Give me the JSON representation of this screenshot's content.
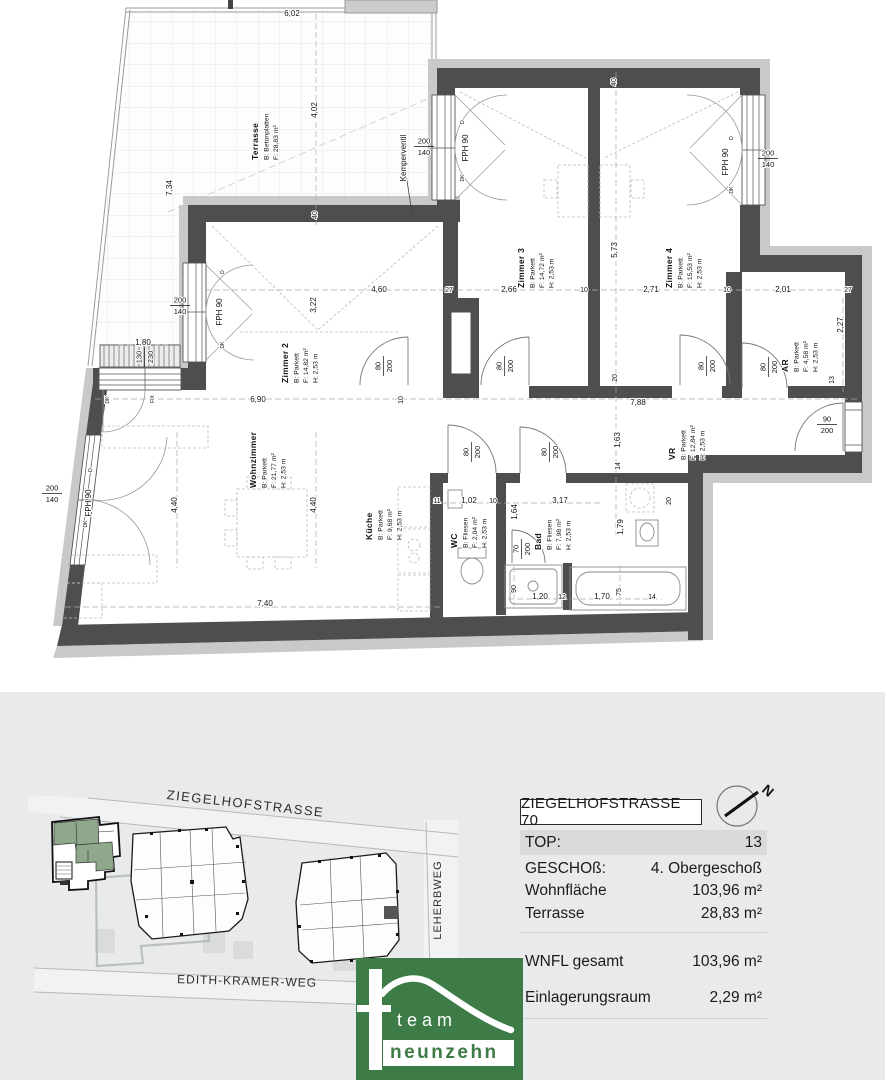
{
  "panel": {
    "address": "ZIEGELHOFSTRASSE 70",
    "compass_n": "N",
    "rows": [
      {
        "label": "TOP:",
        "value": "13"
      },
      {
        "label": "GESCHOß:",
        "value": "4. Obergeschoß"
      },
      {
        "label": "Wohnfläche",
        "value": "103,96 m²"
      },
      {
        "label": "Terrasse",
        "value": "28,83 m²"
      },
      {
        "label": "WNFL gesamt",
        "value": "103,96 m²"
      },
      {
        "label": "Einlagerungsraum",
        "value": "2,29 m²"
      }
    ]
  },
  "site": {
    "streets": [
      "ZIEGELHOFSTRASSE",
      "EDITH-KRAMER-WEG",
      "LEHERBWEG"
    ]
  },
  "logo": {
    "line1": "team",
    "line2": "neunzehn",
    "green": "#3d7b47"
  },
  "plan": {
    "rooms": [
      {
        "name": "Terrasse",
        "lines": [
          "B: Betonplatten",
          "F:  28,83 m²"
        ],
        "x": 258,
        "y": 160
      },
      {
        "name": "Zimmer 2",
        "lines": [
          "B:  Parkett",
          "F:  14,82 m²",
          "H:  2,53 m"
        ],
        "x": 288,
        "y": 383
      },
      {
        "name": "Zimmer 3",
        "lines": [
          "B:  Parkett",
          "F:  14,72 m²",
          "H:  2,53 m"
        ],
        "x": 524,
        "y": 288
      },
      {
        "name": "Zimmer 4",
        "lines": [
          "B:  Parkett",
          "F:  15,53 m²",
          "H:  2,53 m"
        ],
        "x": 672,
        "y": 288
      },
      {
        "name": "Wohnzimmer",
        "lines": [
          "B:  Parkett",
          "F:  21,77 m²",
          "H:  2,53 m"
        ],
        "x": 256,
        "y": 488
      },
      {
        "name": "Küche",
        "lines": [
          "B: Parkett",
          "F: 9,68 m²",
          "H: 2,53 m"
        ],
        "x": 372,
        "y": 540
      },
      {
        "name": "WC",
        "lines": [
          "B: Fliesen",
          "F: 2,04 m²",
          "H: 2,53 m"
        ],
        "x": 457,
        "y": 548
      },
      {
        "name": "Bad",
        "lines": [
          "B: Fliesen",
          "F: 7,98 m²",
          "H: 2,53 m"
        ],
        "x": 541,
        "y": 550
      },
      {
        "name": "VR",
        "lines": [
          "B: Parkett",
          "F: 12,84 m²",
          "H: 2,53 m"
        ],
        "x": 675,
        "y": 460
      },
      {
        "name": "AR",
        "lines": [
          "B: Parkett",
          "F: 4,58 m²",
          "H: 2,53 m"
        ],
        "x": 788,
        "y": 372
      }
    ],
    "labels": [
      {
        "t": "6,02",
        "x": 292,
        "y": 16
      },
      {
        "t": "7,34",
        "x": 172,
        "y": 188,
        "r": -90
      },
      {
        "t": "4,02",
        "x": 317,
        "y": 110,
        "r": -90
      },
      {
        "t": "40",
        "x": 317,
        "y": 215,
        "r": -90,
        "s": 7
      },
      {
        "t": "40",
        "x": 616,
        "y": 82,
        "r": -90,
        "s": 7
      },
      {
        "t": "Kemperventil",
        "x": 406,
        "y": 158,
        "r": -90
      },
      {
        "t": "FPH 90",
        "x": 468,
        "y": 148,
        "r": -90
      },
      {
        "t": "FPH 90",
        "x": 728,
        "y": 162,
        "r": -90
      },
      {
        "t": "FPH 90",
        "x": 222,
        "y": 312,
        "r": -90
      },
      {
        "t": "FPH 90",
        "x": 91,
        "y": 503,
        "r": -90
      },
      {
        "t": "2,66",
        "x": 509,
        "y": 292
      },
      {
        "t": "10",
        "x": 584,
        "y": 292,
        "s": 7
      },
      {
        "t": "2,71",
        "x": 651,
        "y": 292
      },
      {
        "t": "10",
        "x": 727,
        "y": 292,
        "s": 7
      },
      {
        "t": "2,01",
        "x": 783,
        "y": 292
      },
      {
        "t": "27",
        "x": 848,
        "y": 292,
        "s": 7
      },
      {
        "t": "27",
        "x": 449,
        "y": 292,
        "s": 7
      },
      {
        "t": "4,60",
        "x": 379,
        "y": 292
      },
      {
        "t": "3,22",
        "x": 316,
        "y": 305,
        "r": -90
      },
      {
        "t": "5,73",
        "x": 617,
        "y": 250,
        "r": -90
      },
      {
        "t": "6,90",
        "x": 258,
        "y": 402
      },
      {
        "t": "10",
        "x": 403,
        "y": 400,
        "r": -90,
        "s": 7
      },
      {
        "t": "7,88",
        "x": 638,
        "y": 405
      },
      {
        "t": "20",
        "x": 617,
        "y": 378,
        "r": -90,
        "s": 7
      },
      {
        "t": "1,63",
        "x": 620,
        "y": 440,
        "r": -90
      },
      {
        "t": "14",
        "x": 620,
        "y": 466,
        "r": -90,
        "s": 7
      },
      {
        "t": "1,79",
        "x": 623,
        "y": 527,
        "r": -90
      },
      {
        "t": "4,40",
        "x": 177,
        "y": 505,
        "r": -90
      },
      {
        "t": "4,40",
        "x": 316,
        "y": 505,
        "r": -90
      },
      {
        "t": "7,40",
        "x": 265,
        "y": 606
      },
      {
        "t": "11",
        "x": 437,
        "y": 503,
        "s": 7
      },
      {
        "t": "1,02",
        "x": 469,
        "y": 503
      },
      {
        "t": "10",
        "x": 493,
        "y": 503,
        "s": 7
      },
      {
        "t": "3,17",
        "x": 560,
        "y": 503
      },
      {
        "t": "1,64",
        "x": 517,
        "y": 512,
        "r": -90
      },
      {
        "t": "90",
        "x": 516,
        "y": 589,
        "r": -90,
        "s": 7
      },
      {
        "t": "1,20",
        "x": 540,
        "y": 599
      },
      {
        "t": "12",
        "x": 562,
        "y": 599,
        "s": 7
      },
      {
        "t": "1,70",
        "x": 602,
        "y": 599
      },
      {
        "t": "75",
        "x": 621,
        "y": 592,
        "r": -90,
        "s": 7
      },
      {
        "t": "14",
        "x": 652,
        "y": 599,
        "s": 7
      },
      {
        "t": "1,80",
        "x": 143,
        "y": 345
      },
      {
        "t": "2,27",
        "x": 843,
        "y": 325,
        "r": -90
      },
      {
        "t": "13",
        "x": 834,
        "y": 380,
        "r": -90,
        "s": 7
      },
      {
        "t": "20",
        "x": 671,
        "y": 501,
        "r": -90,
        "s": 7
      },
      {
        "t": "D",
        "x": 224,
        "y": 272,
        "r": -90,
        "s": 5,
        "c": "#555"
      },
      {
        "t": "DK",
        "x": 224,
        "y": 345,
        "r": -90,
        "s": 5,
        "c": "#555"
      },
      {
        "t": "D",
        "x": 464,
        "y": 122,
        "r": -90,
        "s": 5,
        "c": "#555"
      },
      {
        "t": "DK",
        "x": 464,
        "y": 178,
        "r": -90,
        "s": 5,
        "c": "#555"
      },
      {
        "t": "D",
        "x": 733,
        "y": 138,
        "r": -90,
        "s": 5,
        "c": "#555"
      },
      {
        "t": "DK",
        "x": 733,
        "y": 190,
        "r": -90,
        "s": 5,
        "c": "#555"
      },
      {
        "t": "D",
        "x": 92,
        "y": 470,
        "r": -90,
        "s": 5,
        "c": "#555"
      },
      {
        "t": "DK",
        "x": 87,
        "y": 524,
        "r": -90,
        "s": 5,
        "c": "#555"
      },
      {
        "t": "DK",
        "x": 109,
        "y": 400,
        "r": -90,
        "s": 5,
        "c": "#555"
      },
      {
        "t": "FIX",
        "x": 154,
        "y": 399,
        "r": -90,
        "s": 5,
        "c": "#555"
      }
    ],
    "fracs": [
      {
        "a": "200",
        "b": "140",
        "x": 424,
        "y": 146
      },
      {
        "a": "200",
        "b": "140",
        "x": 768,
        "y": 158
      },
      {
        "a": "200",
        "b": "140",
        "x": 180,
        "y": 305
      },
      {
        "a": "200",
        "b": "140",
        "x": 52,
        "y": 493
      },
      {
        "a": "130",
        "b": "230",
        "x": 144,
        "y": 357,
        "r": -90
      },
      {
        "a": "80",
        "b": "200",
        "x": 383,
        "y": 366,
        "r": -90
      },
      {
        "a": "80",
        "b": "200",
        "x": 504,
        "y": 366,
        "r": -90
      },
      {
        "a": "80",
        "b": "200",
        "x": 706,
        "y": 366,
        "r": -90
      },
      {
        "a": "80",
        "b": "200",
        "x": 768,
        "y": 367,
        "r": -90
      },
      {
        "a": "80",
        "b": "200",
        "x": 471,
        "y": 452,
        "r": -90
      },
      {
        "a": "80",
        "b": "200",
        "x": 549,
        "y": 452,
        "r": -90
      },
      {
        "a": "70",
        "b": "200",
        "x": 521,
        "y": 549,
        "r": -90
      },
      {
        "a": "90",
        "b": "200",
        "x": 827,
        "y": 424
      }
    ]
  }
}
